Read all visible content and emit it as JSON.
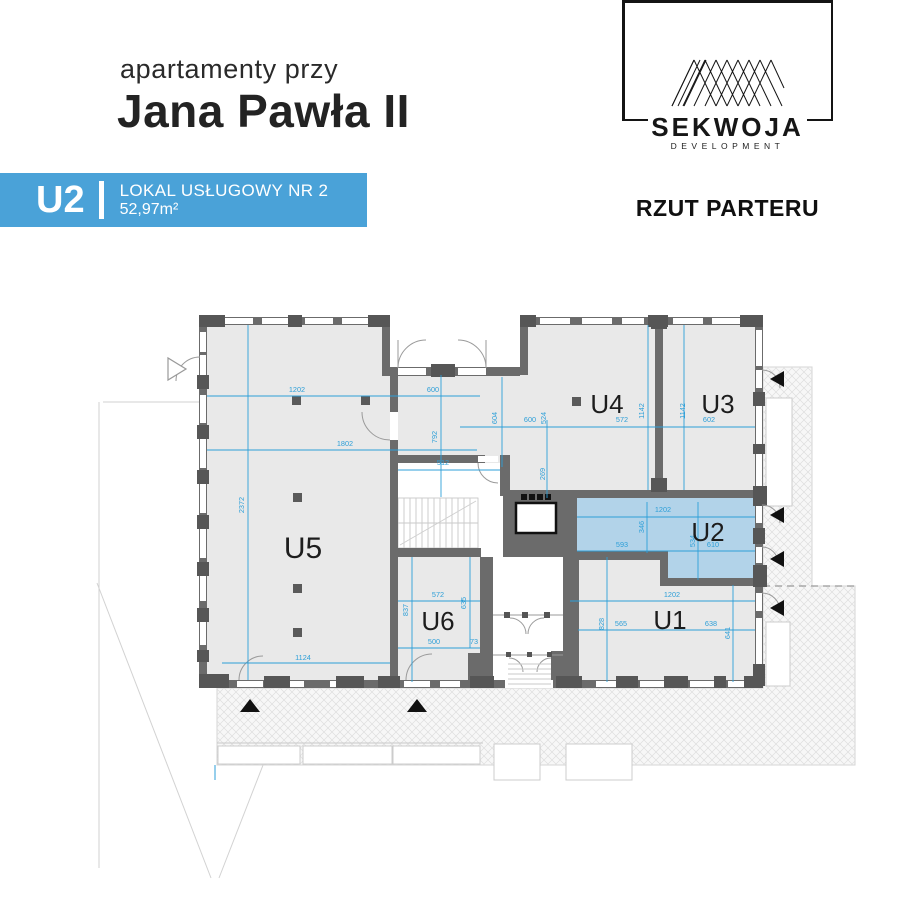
{
  "header": {
    "subtitle": "apartamenty przy",
    "title": "Jana Pawła II"
  },
  "badge": {
    "unit": "U2",
    "name": "LOKAL USŁUGOWY NR 2",
    "area": "52,97m²",
    "color": "#4aa2d8"
  },
  "logo": {
    "brand": "SEKWOJA",
    "tagline": "DEVELOPMENT"
  },
  "plan_title": "RZUT PARTERU",
  "colors": {
    "accent_blue": "#4aa2d8",
    "dimension_blue": "#2d9fd8",
    "highlight_fill": "#b2d3e9",
    "wall_gray": "#6b6b6b",
    "room_fill": "#e9e9e9"
  },
  "plan": {
    "highlighted_unit": "U2",
    "rooms": [
      {
        "id": "U5",
        "x": 303,
        "y": 558,
        "size": 30
      },
      {
        "id": "U4",
        "x": 607,
        "y": 413,
        "size": 26
      },
      {
        "id": "U3",
        "x": 718,
        "y": 413,
        "size": 26
      },
      {
        "id": "U2",
        "x": 708,
        "y": 541,
        "size": 26
      },
      {
        "id": "U1",
        "x": 670,
        "y": 629,
        "size": 26
      },
      {
        "id": "U6",
        "x": 438,
        "y": 630,
        "size": 26
      }
    ],
    "dimensions": [
      {
        "t": "1202",
        "x": 297,
        "y": 392
      },
      {
        "t": "600",
        "x": 433,
        "y": 392
      },
      {
        "t": "1802",
        "x": 345,
        "y": 446
      },
      {
        "t": "2372",
        "x": 244,
        "y": 505,
        "r": 1
      },
      {
        "t": "792",
        "x": 437,
        "y": 437,
        "r": 1
      },
      {
        "t": "512",
        "x": 443,
        "y": 465
      },
      {
        "t": "604",
        "x": 497,
        "y": 418,
        "r": 1
      },
      {
        "t": "600",
        "x": 530,
        "y": 422
      },
      {
        "t": "524",
        "x": 546,
        "y": 418,
        "r": 1
      },
      {
        "t": "572",
        "x": 622,
        "y": 422
      },
      {
        "t": "602",
        "x": 709,
        "y": 422
      },
      {
        "t": "1142",
        "x": 644,
        "y": 411,
        "r": 1
      },
      {
        "t": "1142",
        "x": 685,
        "y": 411,
        "r": 1
      },
      {
        "t": "269",
        "x": 545,
        "y": 474,
        "r": 1
      },
      {
        "t": "1202",
        "x": 663,
        "y": 512
      },
      {
        "t": "346",
        "x": 644,
        "y": 527,
        "r": 1
      },
      {
        "t": "534",
        "x": 695,
        "y": 541,
        "r": 1
      },
      {
        "t": "593",
        "x": 622,
        "y": 547
      },
      {
        "t": "610",
        "x": 713,
        "y": 547
      },
      {
        "t": "1202",
        "x": 672,
        "y": 597
      },
      {
        "t": "828",
        "x": 604,
        "y": 624,
        "r": 1
      },
      {
        "t": "565",
        "x": 621,
        "y": 626
      },
      {
        "t": "638",
        "x": 711,
        "y": 626
      },
      {
        "t": "641",
        "x": 730,
        "y": 633,
        "r": 1
      },
      {
        "t": "572",
        "x": 438,
        "y": 597
      },
      {
        "t": "635",
        "x": 466,
        "y": 603,
        "r": 1
      },
      {
        "t": "837",
        "x": 408,
        "y": 610,
        "r": 1
      },
      {
        "t": "500",
        "x": 434,
        "y": 644
      },
      {
        "t": "73",
        "x": 474,
        "y": 644
      },
      {
        "t": "1124",
        "x": 303,
        "y": 660
      }
    ]
  }
}
